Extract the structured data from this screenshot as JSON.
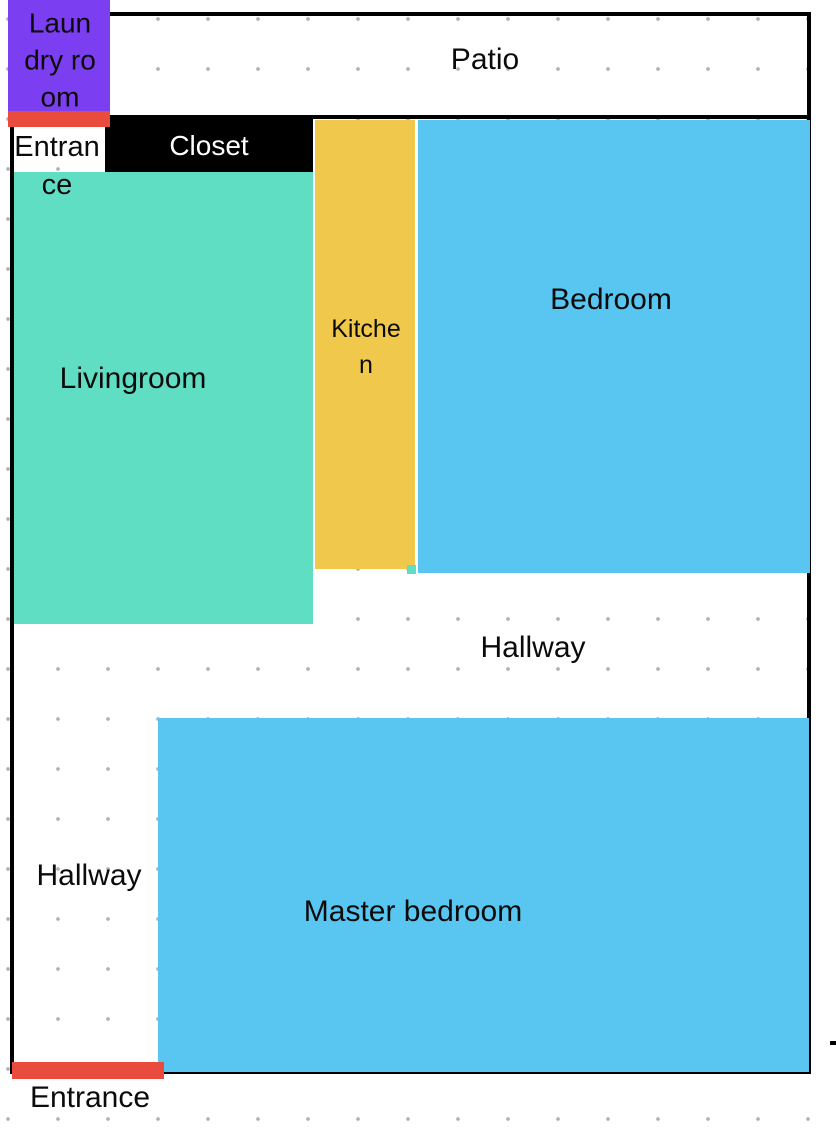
{
  "colors": {
    "background": "#FFFFFF",
    "wall": "#000000",
    "grid_dot": "#B3B3B3",
    "laundry": "#7B3EF0",
    "closet": "#000000",
    "closet_text": "#FFFFFF",
    "livingroom": "#60DEC3",
    "kitchen": "#F0C94C",
    "bedroom": "#59C5F1",
    "master_bedroom": "#59C5F1",
    "door_marker": "#E94C3C",
    "text": "#0B0B0B"
  },
  "rooms": {
    "laundry": {
      "label": "Laundry room"
    },
    "patio": {
      "label": "Patio"
    },
    "entrance_top": {
      "label": "Entrance"
    },
    "closet": {
      "label": "Closet"
    },
    "livingroom": {
      "label": "Livingroom"
    },
    "kitchen": {
      "label": "Kitchen"
    },
    "bedroom": {
      "label": "Bedroom"
    },
    "hallway_upper": {
      "label": "Hallway"
    },
    "hallway_lower": {
      "label": "Hallway"
    },
    "master_bedroom": {
      "label": "Master bedroom"
    },
    "entrance_bottom": {
      "label": "Entrance"
    }
  }
}
